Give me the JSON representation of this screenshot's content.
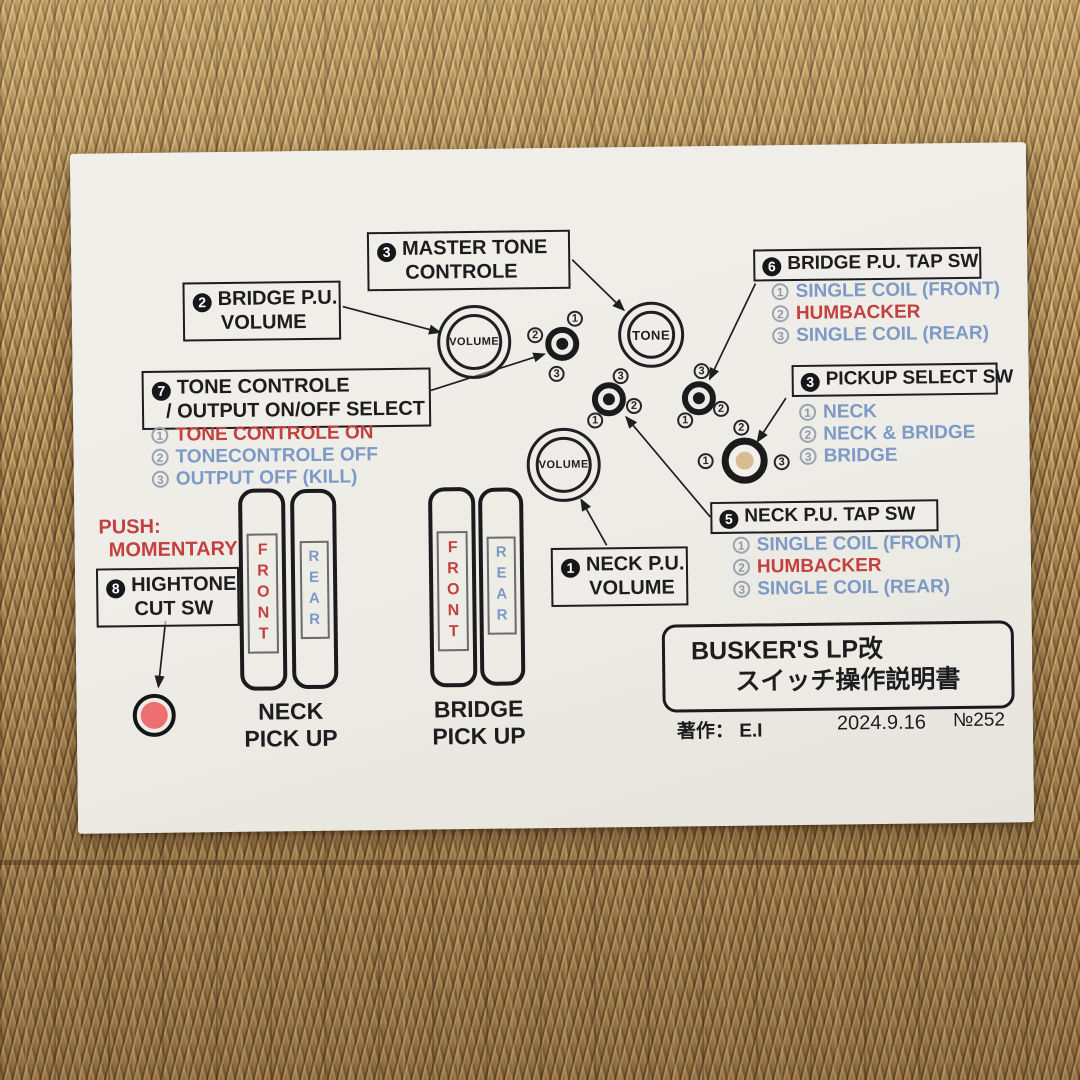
{
  "diagram": {
    "boxes": {
      "master_tone": {
        "num": "3",
        "line1": "MASTER TONE",
        "line2": "CONTROLE"
      },
      "bridge_volume": {
        "num": "2",
        "line1": "BRIDGE P.U.",
        "line2": "VOLUME"
      },
      "tone_controle": {
        "num": "7",
        "line1": "TONE CONTROLE",
        "line2": "/ OUTPUT ON/OFF SELECT"
      },
      "hightone": {
        "num": "8",
        "line1": "HIGHTONE",
        "line2": "CUT SW"
      },
      "neck_volume": {
        "num": "1",
        "line1": "NECK P.U.",
        "line2": "VOLUME"
      },
      "neck_tap": {
        "num": "5",
        "line": "NECK P.U. TAP SW"
      },
      "bridge_tap": {
        "num": "6",
        "line": "BRIDGE P.U. TAP SW"
      },
      "pickup_select": {
        "num": "3",
        "line": "PICKUP SELECT SW"
      }
    },
    "lists": {
      "tone_controle": [
        {
          "n": "1",
          "text": "TONE CONTROLE ON",
          "color": "red"
        },
        {
          "n": "2",
          "text": "TONECONTROLE OFF",
          "color": "blue"
        },
        {
          "n": "3",
          "text": "OUTPUT OFF (KILL)",
          "color": "blue"
        }
      ],
      "bridge_tap": [
        {
          "n": "1",
          "text": "SINGLE COIL (FRONT)",
          "color": "blue"
        },
        {
          "n": "2",
          "text": "HUMBACKER",
          "color": "red"
        },
        {
          "n": "3",
          "text": "SINGLE COIL (REAR)",
          "color": "blue"
        }
      ],
      "pickup_select": [
        {
          "n": "1",
          "text": "NECK",
          "color": "blue"
        },
        {
          "n": "2",
          "text": "NECK & BRIDGE",
          "color": "blue"
        },
        {
          "n": "3",
          "text": "BRIDGE",
          "color": "blue"
        }
      ],
      "neck_tap": [
        {
          "n": "1",
          "text": "SINGLE COIL (FRONT)",
          "color": "blue"
        },
        {
          "n": "2",
          "text": "HUMBACKER",
          "color": "red"
        },
        {
          "n": "3",
          "text": "SINGLE COIL (REAR)",
          "color": "blue"
        }
      ]
    },
    "push_note": {
      "line1": "PUSH:",
      "line2": "MOMENTARY"
    },
    "knobs": {
      "bridge_volume": "VOLUME",
      "master_tone": "TONE",
      "neck_volume": "VOLUME"
    },
    "pickups": {
      "neck": {
        "front": "FRONT",
        "rear": "REAR",
        "label1": "NECK",
        "label2": "PICK UP"
      },
      "bridge": {
        "front": "FRONT",
        "rear": "REAR",
        "label1": "BRIDGE",
        "label2": "PICK UP"
      }
    },
    "digits": {
      "d1": "1",
      "d2": "2",
      "d3": "3"
    },
    "title_box": {
      "line1": "BUSKER'S LP改",
      "line2": "スイッチ操作説明書"
    },
    "credits": {
      "author": "著作： E.I",
      "date": "2024.9.16",
      "number": "№252"
    },
    "colors": {
      "red": "#c4403e",
      "blue": "#7d99c5",
      "ink": "#1d1d20",
      "paper": "#edece6",
      "button_red": "#ed6f6f",
      "select_center": "#d8bc92",
      "mat_tan": "#ab8751",
      "mat_brown": "#5c3a20"
    }
  }
}
